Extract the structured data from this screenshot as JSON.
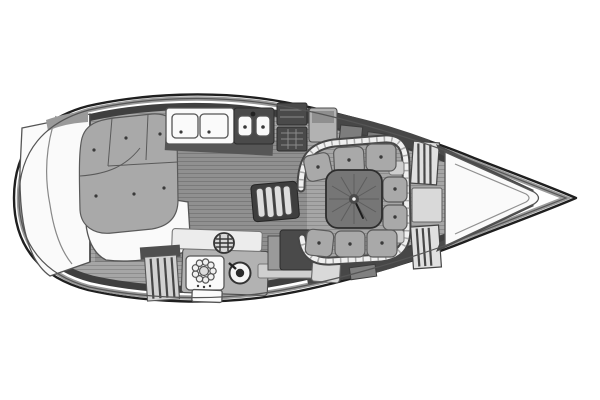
{
  "canvas": {
    "width": 600,
    "height": 400
  },
  "diagram": {
    "type": "boat-floor-plan",
    "subject": "sailing yacht interior layout, plan view, bow to the right",
    "orientation": {
      "bow": "right",
      "stern": "left"
    },
    "areas": [
      {
        "id": "hull",
        "label": "hull outline with inner deck line"
      },
      {
        "id": "stern-transom",
        "label": "rounded stern transom and lazarette area"
      },
      {
        "id": "aft-cabin",
        "label": "aft cabin double berth with buttoned cushions"
      },
      {
        "id": "aft-cabin-floor",
        "label": "aft cabin white floor area"
      },
      {
        "id": "head-vanity",
        "label": "head compartment counter with two doors and twin sink unit"
      },
      {
        "id": "top-lockers",
        "label": "port-side storage lockers"
      },
      {
        "id": "galley",
        "label": "galley with round vent, gas burner and sink"
      },
      {
        "id": "galley-locker",
        "label": "slatted galley locker front"
      },
      {
        "id": "companionway",
        "label": "curved companionway steps"
      },
      {
        "id": "nav-station",
        "label": "navigation table block"
      },
      {
        "id": "dinette",
        "label": "U-shaped salon settee with piping and buttoned cushions"
      },
      {
        "id": "salon-table",
        "label": "square pedestal table with radial wood grain"
      },
      {
        "id": "forward-lockers",
        "label": "forward bulkhead slatted lockers and doorway"
      },
      {
        "id": "v-berth-bow",
        "label": "forward V section and pointed bow"
      }
    ],
    "palette": {
      "background": "#ffffff",
      "hull_line": "#1f1f1f",
      "deck_line": "#555555",
      "rim": "#3f3f3f",
      "floor": "#a6a6a6",
      "floor_hatch": "#8d8d8d",
      "cushion": "#a9a9a9",
      "cushion_seam": "#5a5a5a",
      "white_fixture": "#fafafa",
      "mid_fixture": "#b2b2b2",
      "dark_fixture": "#4a4a4a",
      "table_top": "#767676",
      "table_grain": "#5d5d5d",
      "button_dot": "#3a3a3a"
    }
  }
}
